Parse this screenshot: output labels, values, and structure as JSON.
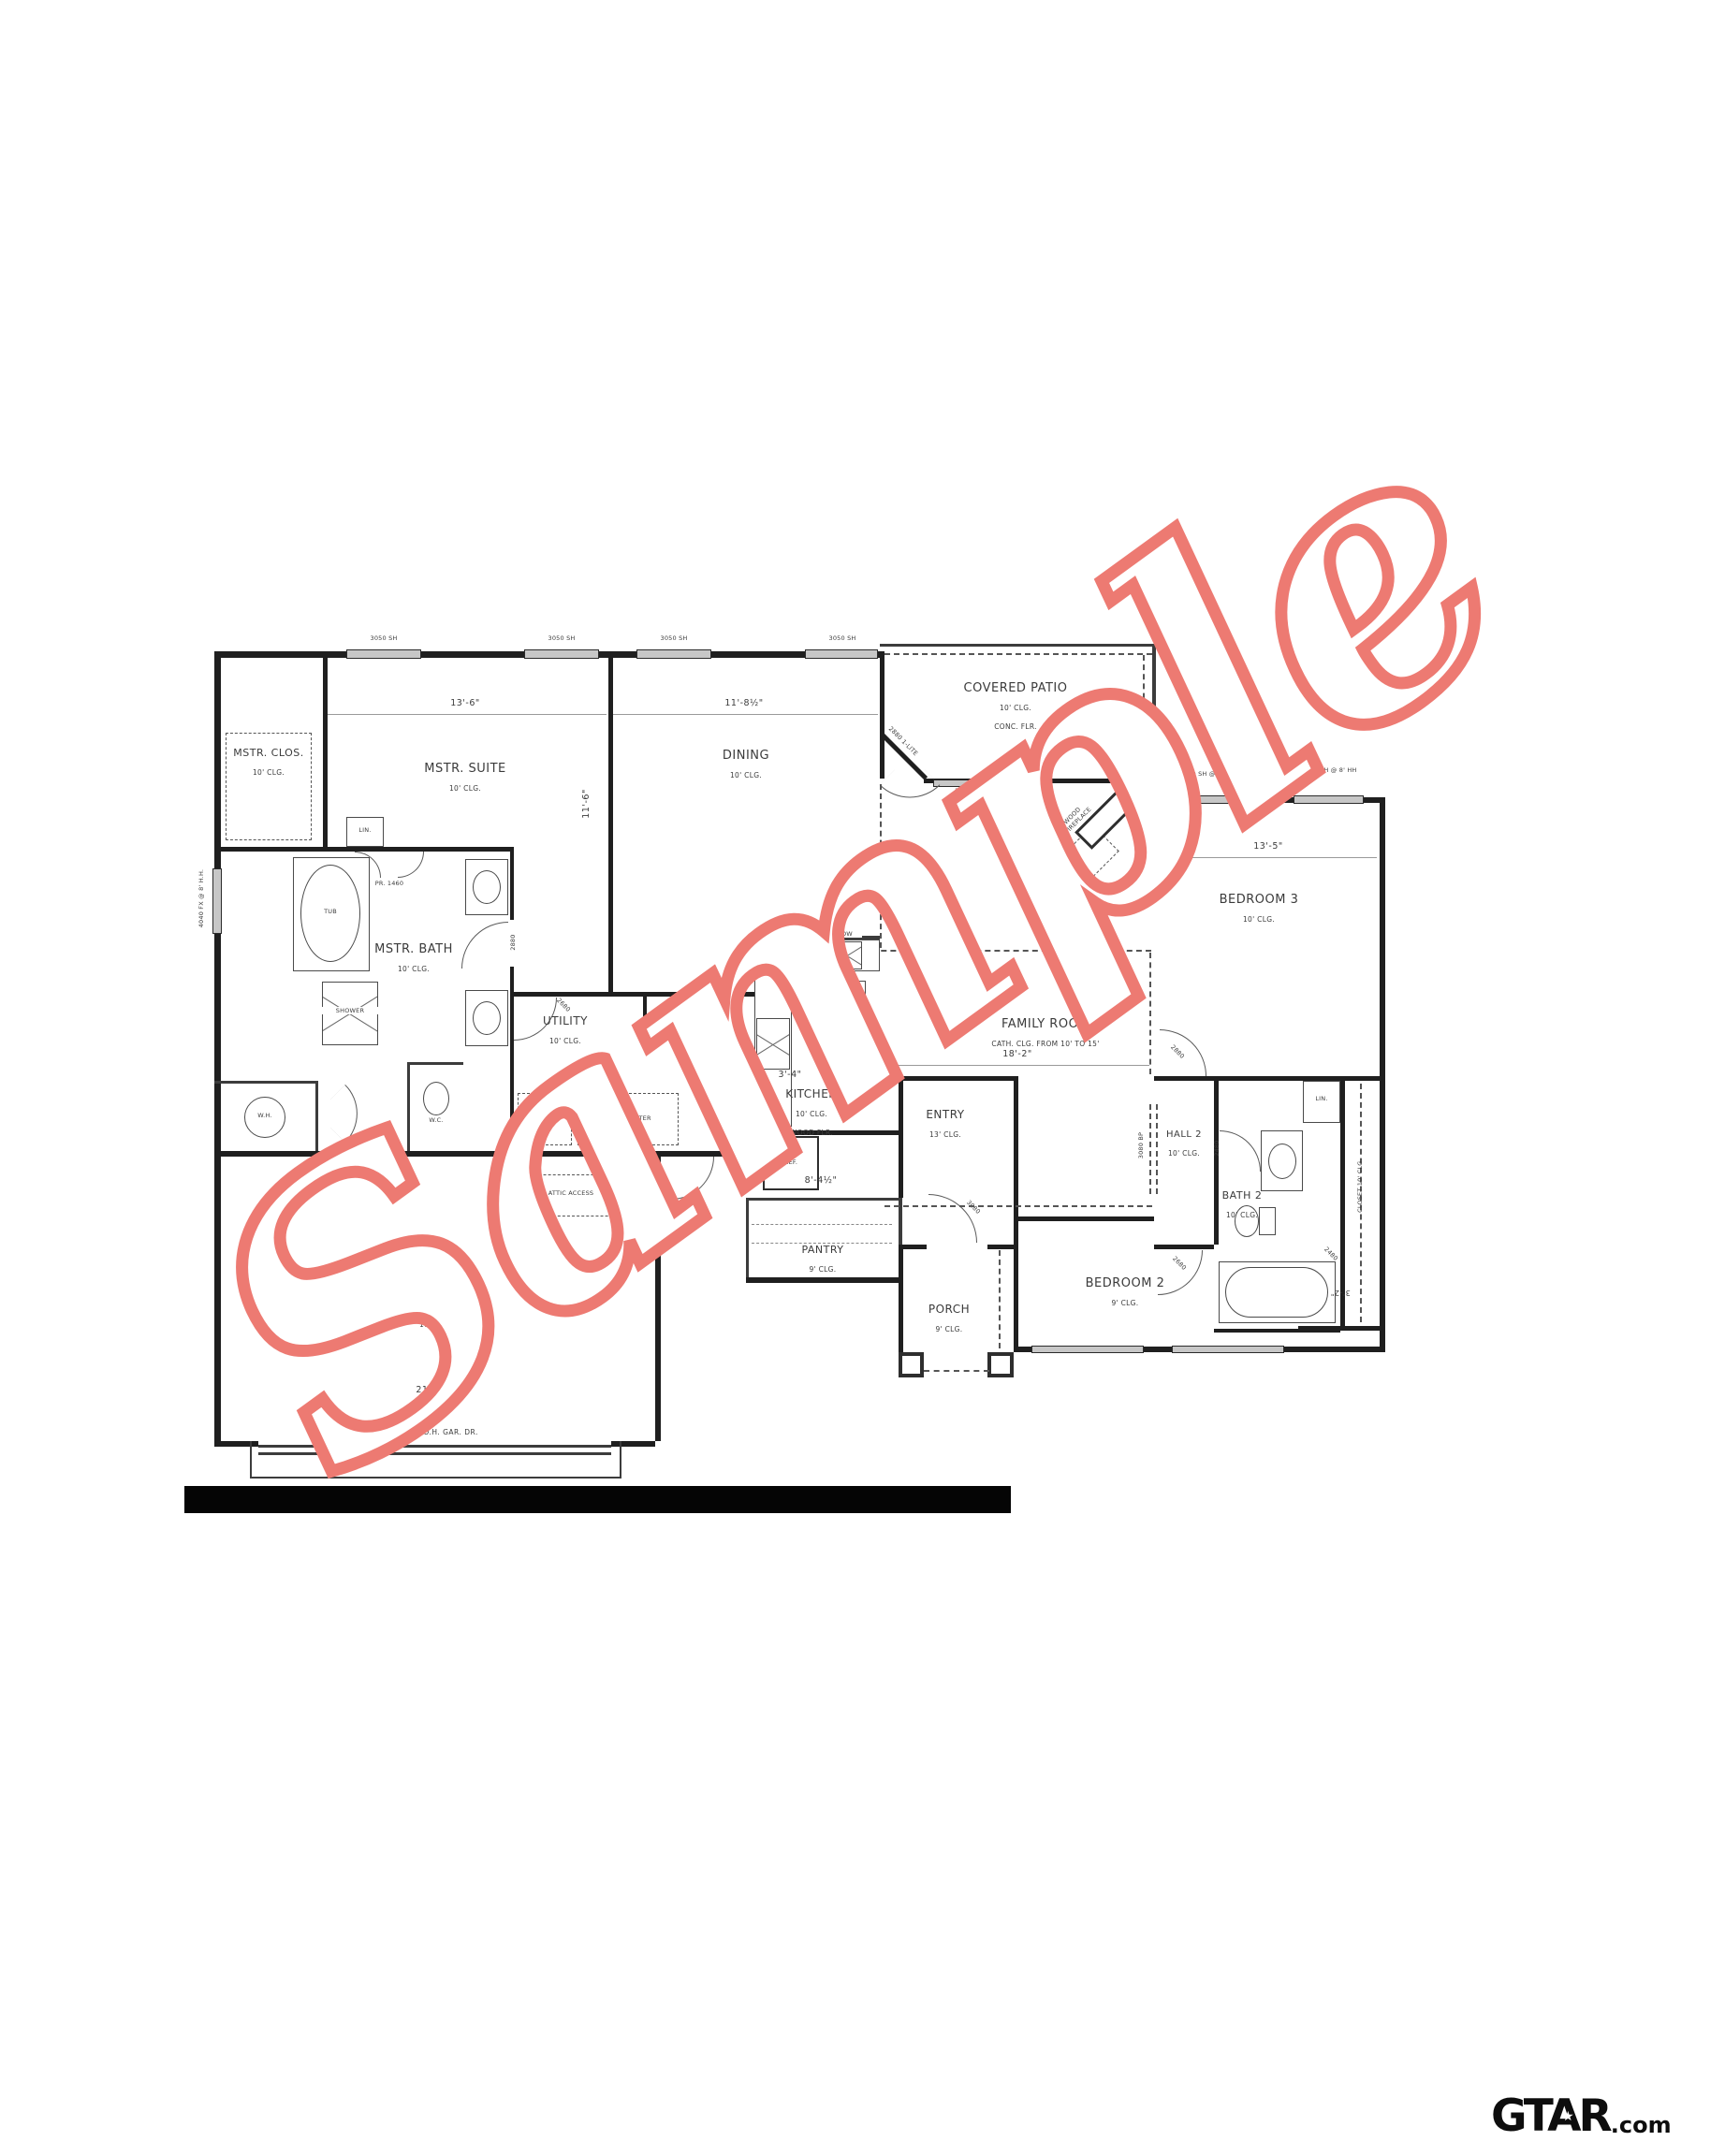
{
  "watermark": {
    "text": "Sample",
    "color": "#ed7a72"
  },
  "logo": {
    "brand": "GTAR",
    "star": "★",
    "suffix": ".com"
  },
  "rooms": {
    "mstr_clos": {
      "name": "MSTR. CLOS.",
      "line2": "10' CLG."
    },
    "mstr_suite": {
      "name": "MSTR. SUITE",
      "line2": "10' CLG."
    },
    "dining": {
      "name": "DINING",
      "line2": "10' CLG."
    },
    "covered_patio": {
      "name": "COVERED PATIO",
      "line2": "10' CLG.",
      "line3": "CONC. FLR."
    },
    "bedroom3": {
      "name": "BEDROOM 3",
      "line2": "10' CLG."
    },
    "mstr_bath": {
      "name": "MSTR. BATH",
      "line2": "10' CLG."
    },
    "utility": {
      "name": "UTILITY",
      "line2": "10' CLG."
    },
    "mud": {
      "name": "MUD",
      "line2": "10' CLG."
    },
    "kitchen": {
      "name": "KITCHEN",
      "line2": "10' CLG.",
      "line3": "WOOD FLR."
    },
    "family_room": {
      "name": "FAMILY ROOM",
      "line2": "CATH. CLG. FROM 10' TO 15'"
    },
    "entry": {
      "name": "ENTRY",
      "line2": "13' CLG."
    },
    "pantry": {
      "name": "PANTRY",
      "line2": "9' CLG."
    },
    "hall2": {
      "name": "HALL 2",
      "line2": "10' CLG."
    },
    "bath2": {
      "name": "BATH 2",
      "line2": "10' CLG."
    },
    "closet2": {
      "name": "CLOSET 10' CLG."
    },
    "bedroom2": {
      "name": "BEDROOM 2",
      "line2": "9' CLG."
    },
    "porch": {
      "name": "PORCH",
      "line2": "9' CLG."
    },
    "garage": {
      "name": "2 CAR GARAGE",
      "line2": "10' CLG."
    }
  },
  "dimensions": {
    "mstr_suite_width": "13'-6\"",
    "dining_width": "11'-8½\"",
    "bedroom3_width": "13'-5\"",
    "family_room_width": "18'-2\"",
    "kitchen_island_a": "3'-4\"",
    "kitchen_island_b": "5'-4\"",
    "pantry_width": "8'-4½\"",
    "garage_width": "21'-1½\"",
    "mstr_suite_depth": "11'-6\"",
    "closet_depth": "3'-2\""
  },
  "fixtures": {
    "tub": "TUB",
    "shower": "SHOWER",
    "water_heater": "W.H.",
    "water_closet": "W.C.",
    "linen1": "LIN.",
    "linen2": "LIN.",
    "bench": "BENCH",
    "washer": "WASH",
    "dryer": "DRY/COUNTER",
    "attic": "ATTIC ACCESS",
    "fridge": "REF.",
    "dishwasher": "DW",
    "farm_sink": "FARM SINK",
    "range": "RANGE MICRO ABOVE",
    "pair_door": "PR. 1460",
    "fireplace_line1": "36\" MTL. WOOD",
    "fireplace_line2": "BURNING FIREPLACE",
    "garage_door": "16080 O.H. GAR. DR."
  },
  "openings": {
    "patio_window": "2 + 3070 SH @ 8' HH",
    "bed3_window_left": "3070 SH @ 8' HH",
    "bed3_window_right": "3070 SH @ 8' HH",
    "suite_window_1": "3050 SH",
    "suite_window_2": "3050 SH",
    "dining_window_1": "3050 SH",
    "dining_window_2": "3050 SH",
    "bath_window": "4040 FX @ 8' H.H.",
    "patio_door": "2880 1-LITE",
    "door_suite": "2880",
    "door_utility": "2680",
    "door_mud": "2880",
    "door_entry": "3080",
    "door_bed3": "2880",
    "door_hall_bottom": "2680",
    "door_bath2": "2480",
    "door_closet": "2480",
    "hall_bypass": "3080 BP"
  }
}
